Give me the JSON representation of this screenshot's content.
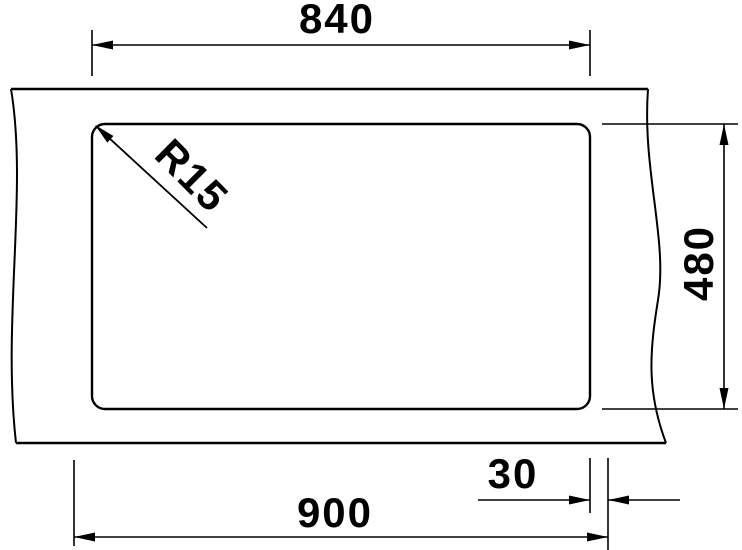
{
  "diagram": {
    "type": "technical-dimension-drawing",
    "colors": {
      "ink": "#000000",
      "background": "#ffffff"
    },
    "dimensions": {
      "cutout_width": {
        "label": "840"
      },
      "cutout_depth": {
        "label": "480"
      },
      "cabinet_width": {
        "label": "900"
      },
      "edge_offset": {
        "label": "30"
      },
      "corner_radius": {
        "label": "R15"
      }
    }
  }
}
